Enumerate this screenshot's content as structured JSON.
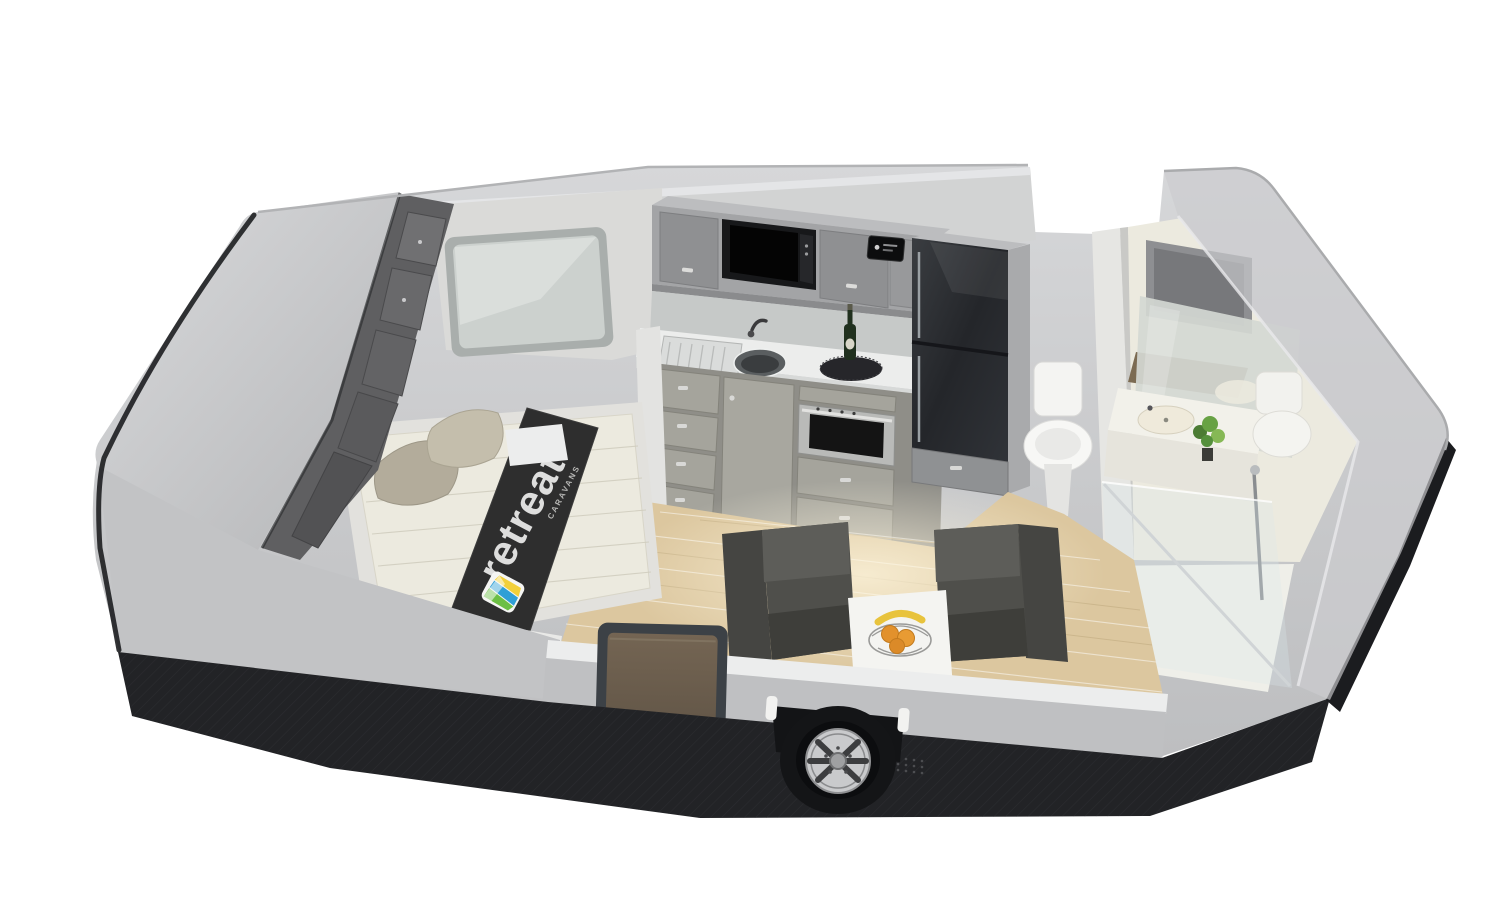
{
  "scene": {
    "title": "3D cutaway floor-plan render of a Retreat caravan interior",
    "background_color": "#ffffff",
    "view": "isometric cutaway, roof and near wall removed"
  },
  "branding": {
    "runner_text": "retreat",
    "runner_subtext": "CARAVANS"
  },
  "palette": {
    "body_grey": "#c9cacc",
    "body_grey_light": "#d8d9db",
    "chassis_trim_black": "#222326",
    "interior_wall_grey": "#d2d3d3",
    "bathroom_wall_cream": "#eceadf",
    "floor_timber": "#dcc79f",
    "cabinet_grey": "#9fa0a2",
    "wardrobe_dark_grey": "#5f5f61",
    "mattress_white": "#eceadf",
    "runner_black": "#2e2e2e",
    "sofa_charcoal": "#4e4e4a",
    "fridge_black": "#2e3134",
    "door_brown": "#6e604f",
    "logo_blue": "#2f9fd6",
    "logo_green": "#6cbf44",
    "logo_yellow": "#f2d03a",
    "fruit_orange": "#e2912c",
    "fruit_banana": "#e8c33c"
  },
  "features": [
    "front-nose-panel",
    "wardrobe",
    "bed",
    "pillows",
    "bed-runner",
    "front-window",
    "overhead-lockers",
    "microwave",
    "stereo-panel",
    "kitchen-sink",
    "tap",
    "wine-bottle",
    "kitchen-drawers",
    "oven",
    "fridge",
    "toilet",
    "bathroom-vanity",
    "vanity-mirror",
    "plant",
    "shower-enclosure",
    "lounge-seats",
    "coffee-table",
    "fruit-basket",
    "entry-door",
    "alloy-wheel",
    "chassis-trim"
  ]
}
